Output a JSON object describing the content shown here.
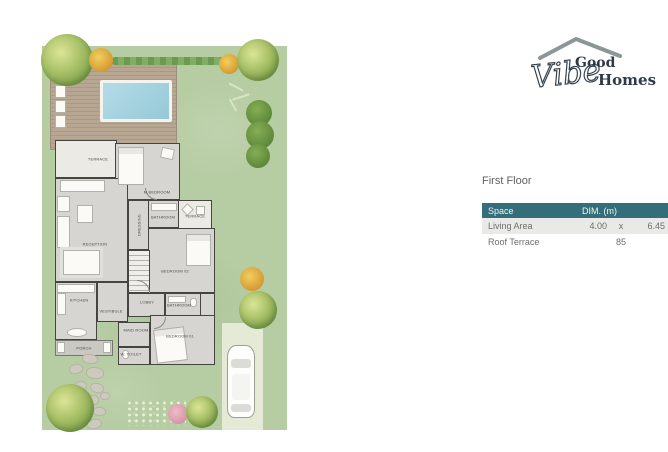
{
  "logo": {
    "word1": "Good",
    "script": "Vibe",
    "word2": "Homes"
  },
  "section": {
    "title": "First Floor"
  },
  "table": {
    "headers": {
      "space": "Space",
      "dim": "DIM. (m)"
    },
    "rows": [
      {
        "space": "Living Area",
        "v1": "4.00",
        "v2": "x",
        "v3": "6.45"
      },
      {
        "space": "Roof Terrace",
        "v1": "",
        "v2": "85",
        "v3": ""
      }
    ]
  },
  "plan": {
    "rooms": {
      "terrace_tl": "TERRACE",
      "m_bedroom": "M.BEDROOM",
      "reception": "RECEPTION",
      "dressing": "DRESSING",
      "bathroom_1": "BATHROOM",
      "terrace_r": "TERRACE",
      "bedroom_02": "BEDROOM 02",
      "lobby": "LOBBY",
      "bathroom_2": "BATHROOM",
      "kitchen": "KITCHEN",
      "vestibule": "VESTIBULE",
      "maid_room": "MAID ROOM",
      "w_toilet": "W. TOILET",
      "bedroom_01": "BEDROOM 01",
      "porch": "PORCH"
    }
  },
  "colors": {
    "brand_teal": "#336e7a",
    "logo_text": "#2f3a48",
    "roof_gray": "#8b9697",
    "garden_green": "#b6cca3",
    "pool_blue": "#a5d2df",
    "deck_tan": "#b3a28e",
    "row_alt": "#e9e9e7"
  }
}
